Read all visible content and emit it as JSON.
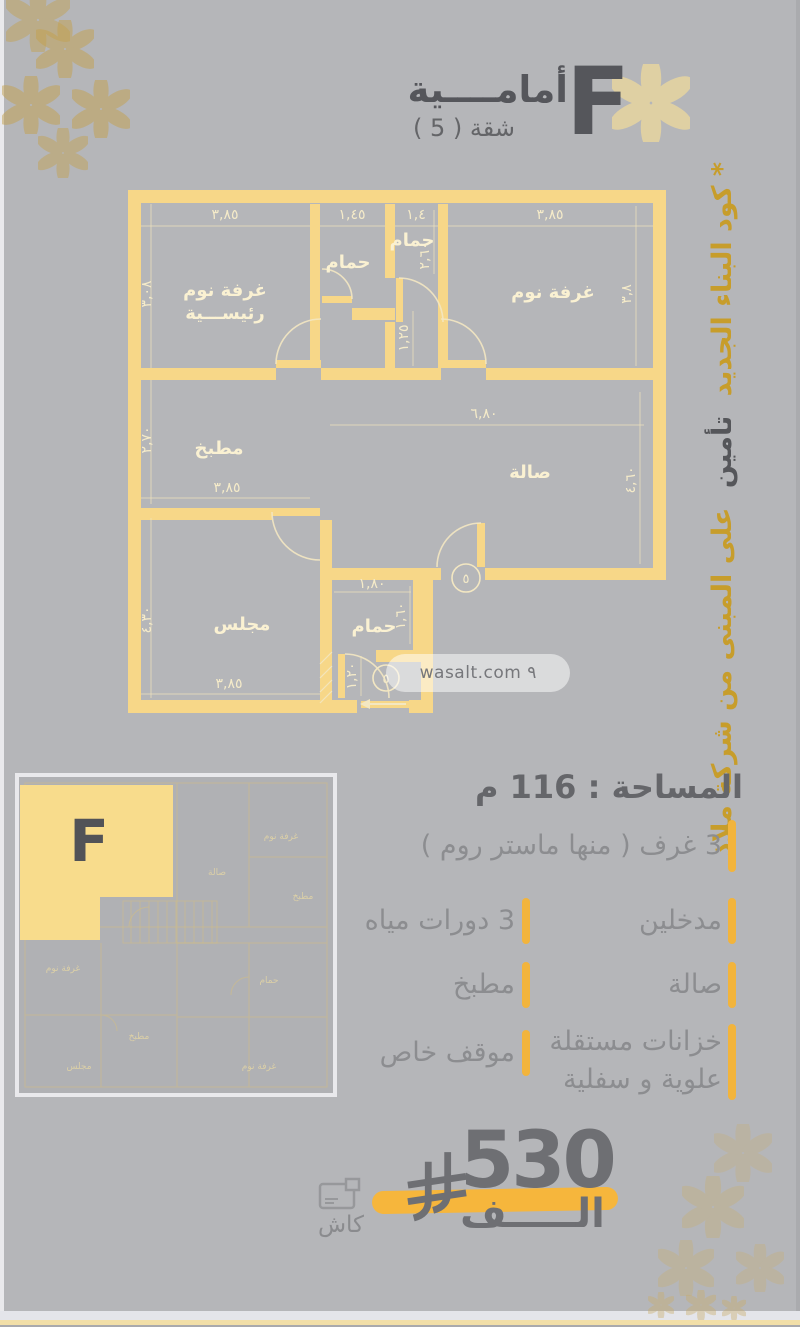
{
  "header": {
    "unit_letter": "F",
    "title": "أمامــــية",
    "subtitle": "شقة ( 5 )"
  },
  "side_note": {
    "part1": "* كود البناء الجديد",
    "part2": "تأمين",
    "part3": "على المبنى من شركة ملاذ"
  },
  "floorplan": {
    "rooms": {
      "master_l1": "غرفة نوم",
      "master_l2": "رئيســـية",
      "bath1": "حمام",
      "bath2": "حمام",
      "bedroom": "غرفة نوم",
      "kitchen": "مطبخ",
      "hall": "صالة",
      "majlis": "مجلس",
      "bath3": "حمام"
    },
    "dims": {
      "top_master": "٣,٨٥",
      "top_bath1": "١,٤٥",
      "top_bath2": "١,٤",
      "top_bedroom": "٣,٨٥",
      "left_master": "٣,٠٨",
      "left_kitchen": "٢,٧٠",
      "left_majlis": "٤,٣٠",
      "kitchen_width": "٣,٨٥",
      "majlis_width": "٣,٨٥",
      "hall_width": "٦,٨٠",
      "hall_entry": "١,٢٥",
      "right_bedroom": "٣,٨",
      "right_hall": "٤,٦٠",
      "bath2_height": "٢,٦٠",
      "bath3_width": "١,٨٠",
      "bath3_height": "١,٦٠",
      "bath3_door": "١,٢٠"
    },
    "door_tag": "٥",
    "watermark": "wasalt.com ٩"
  },
  "thumbnail": {
    "unit_letter": "F",
    "labels": [
      "غرفة نوم",
      "مطبخ",
      "صالة",
      "حمام",
      "غرفة نوم",
      "مجلس",
      "غرفة نوم",
      "مطبخ"
    ]
  },
  "details": {
    "area_title": "المساحة : 116 م",
    "right_items": [
      {
        "text": "3 غرف ( منها ماستر روم )"
      },
      {
        "text": "مدخلين"
      },
      {
        "text": "صالة"
      },
      {
        "text": "خزانات مستقلة",
        "text2": "علوية و سفلية"
      }
    ],
    "left_items": [
      {
        "text": "3 دورات مياه"
      },
      {
        "text": "مطبخ"
      },
      {
        "text": "موقف خاص"
      }
    ]
  },
  "price": {
    "amount": "530",
    "thousand_label": "الـــــف",
    "cash_label": "كاش"
  },
  "icons": {
    "flower-icon": "six-petal ornament",
    "saudi-riyal-icon": "new SAR currency symbol",
    "cash-icon": "payment card outline"
  },
  "colors": {
    "background": "#b5b6b9",
    "wall_yellow": "#f7d788",
    "cream_label": "#faf1d2",
    "gold_text": "#c79d2b",
    "dark_text": "#55565a",
    "accent_bar": "#f2b43c",
    "swoosh": "#f6b63c",
    "unit_fill": "#f8dc8c"
  }
}
